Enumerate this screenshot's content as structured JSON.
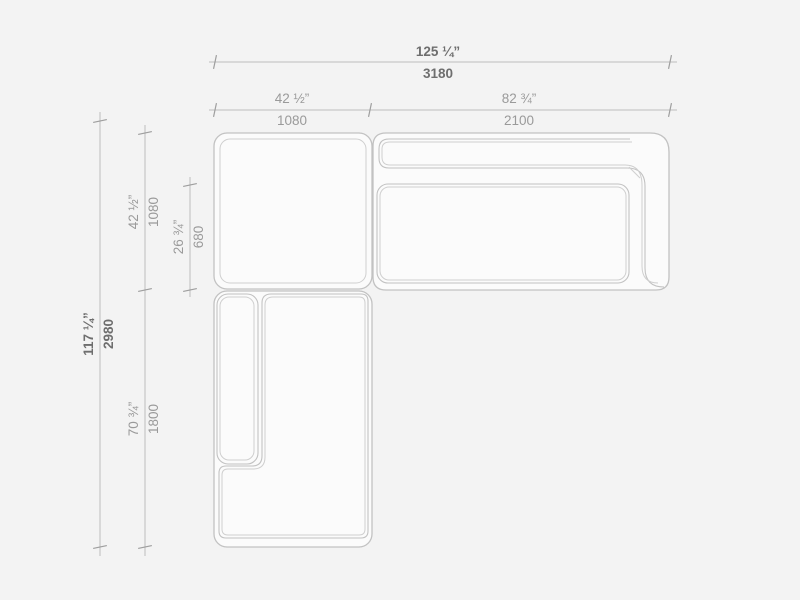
{
  "colors": {
    "background": "#f3f3f3",
    "module_fill": "#fbfbfb",
    "outline": "#c2c2c2",
    "outline_inner": "#cfcfcf",
    "dim_line": "#bcbcbc",
    "tick": "#9e9e9e",
    "dim_text": "#9a9a9a",
    "dim_text_strong": "#6e6e6e"
  },
  "drawing": {
    "view": "sectional-sofa-top-view-dimension-plan",
    "dimensions": {
      "overall_width": {
        "inches": "125 ¼”",
        "mm": "3180"
      },
      "left_section_width": {
        "inches": "42 ½”",
        "mm": "1080"
      },
      "right_section_width": {
        "inches": "82 ¾”",
        "mm": "2100"
      },
      "overall_depth": {
        "inches": "117 ¼”",
        "mm": "2980"
      },
      "upper_section_depth": {
        "inches": "42 ½”",
        "mm": "1080"
      },
      "seat_depth": {
        "inches": "26 ¾”",
        "mm": "680"
      },
      "lower_section_depth": {
        "inches": "70 ¾”",
        "mm": "1800"
      }
    }
  }
}
